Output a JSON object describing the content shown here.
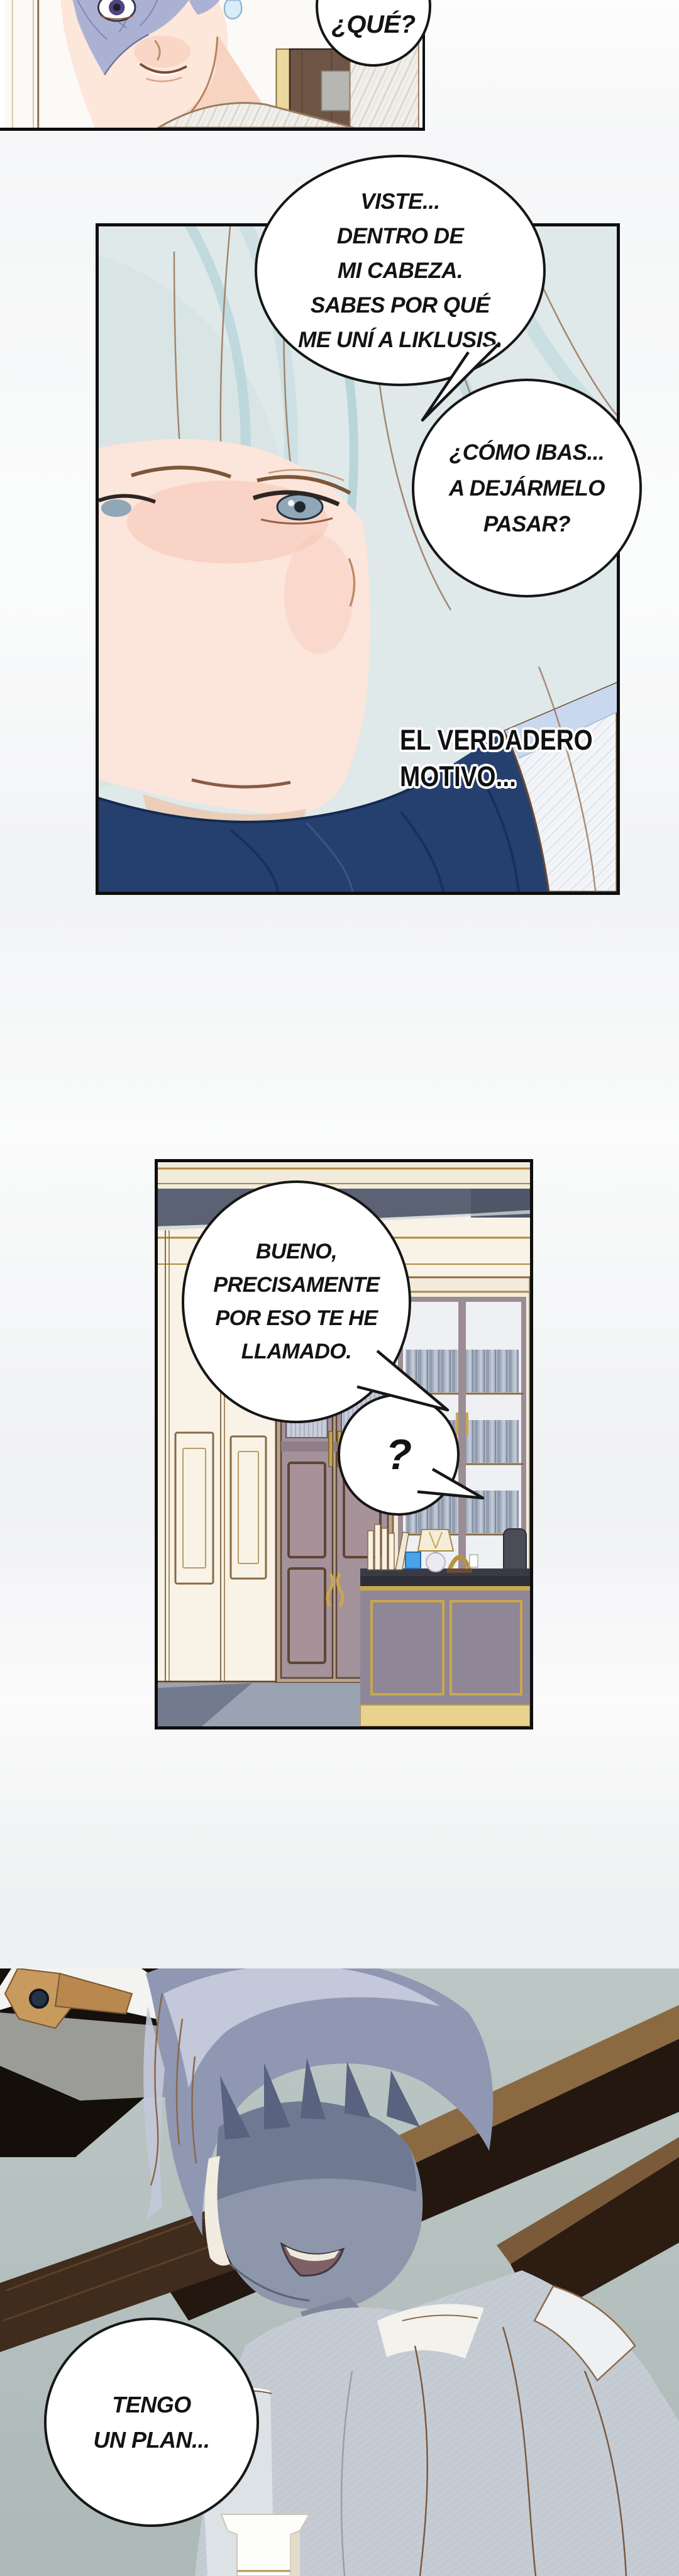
{
  "page": {
    "kind": "webtoon-comic-page",
    "language": "es"
  },
  "colors": {
    "page_background": "#f5f6f7",
    "panel_border": "#0e0e0e",
    "bubble_fill": "#ffffff",
    "bubble_border": "#161616",
    "bubble_text": "#131313",
    "panel1_hair_lavender": "#abb1d3",
    "panel2_background": "#dfe9ea",
    "panel2_pale_hair": "#dfe9e7",
    "panel2_navy_sweater": "#25406e",
    "panel2_jacket_lining": "#c8d8ee",
    "skin": "#fde6da",
    "panel3_ceiling_slate": "#5b6274",
    "panel3_wall_cream": "#f8f3e6",
    "panel3_gold_trim": "#b0893e",
    "panel3_bookcase_mauve": "#a3929a",
    "panel3_desk_front": "#8f8798",
    "panel3_desk_base_gold": "#e7d28e",
    "panel3_blue_cube": "#4aa3e8",
    "panel3_floor": "#9aa3b2",
    "panel4_background": "#b7c2c1",
    "panel4_beam_dark": "#231710",
    "panel4_beam_wood": "#8b6a42",
    "panel4_hair_blue_gray": "#8f97b2",
    "panel4_face_shadow": "#8d96aa",
    "panel4_shirt_gray": "#c6ccd3"
  },
  "panels": [
    {
      "id": "panel-1",
      "bubbles": [
        {
          "id": "bubble-que",
          "lines": [
            "¿QUÉ?"
          ]
        }
      ]
    },
    {
      "id": "panel-2",
      "bubbles": [
        {
          "id": "bubble-viste",
          "lines": [
            "VISTE...",
            "DENTRO DE",
            "MI CABEZA.",
            "SABES POR QUÉ",
            "ME UNÍ A LIKLUSIS."
          ]
        },
        {
          "id": "bubble-como",
          "lines": [
            "¿CÓMO IBAS...",
            "A DEJÁRMELO",
            "PASAR?"
          ]
        }
      ],
      "caption": {
        "id": "caption-motivo",
        "lines": [
          "EL VERDADERO",
          "MOTIVO..."
        ]
      }
    },
    {
      "id": "panel-3",
      "bubbles": [
        {
          "id": "bubble-bueno",
          "lines": [
            "BUENO,",
            "PRECISAMENTE",
            "POR ESO TE HE",
            "LLAMADO."
          ]
        },
        {
          "id": "bubble-question",
          "lines": [
            "?"
          ]
        }
      ]
    },
    {
      "id": "panel-4",
      "bubbles": [
        {
          "id": "bubble-plan",
          "lines": [
            "TENGO",
            "UN PLAN..."
          ]
        }
      ]
    }
  ]
}
